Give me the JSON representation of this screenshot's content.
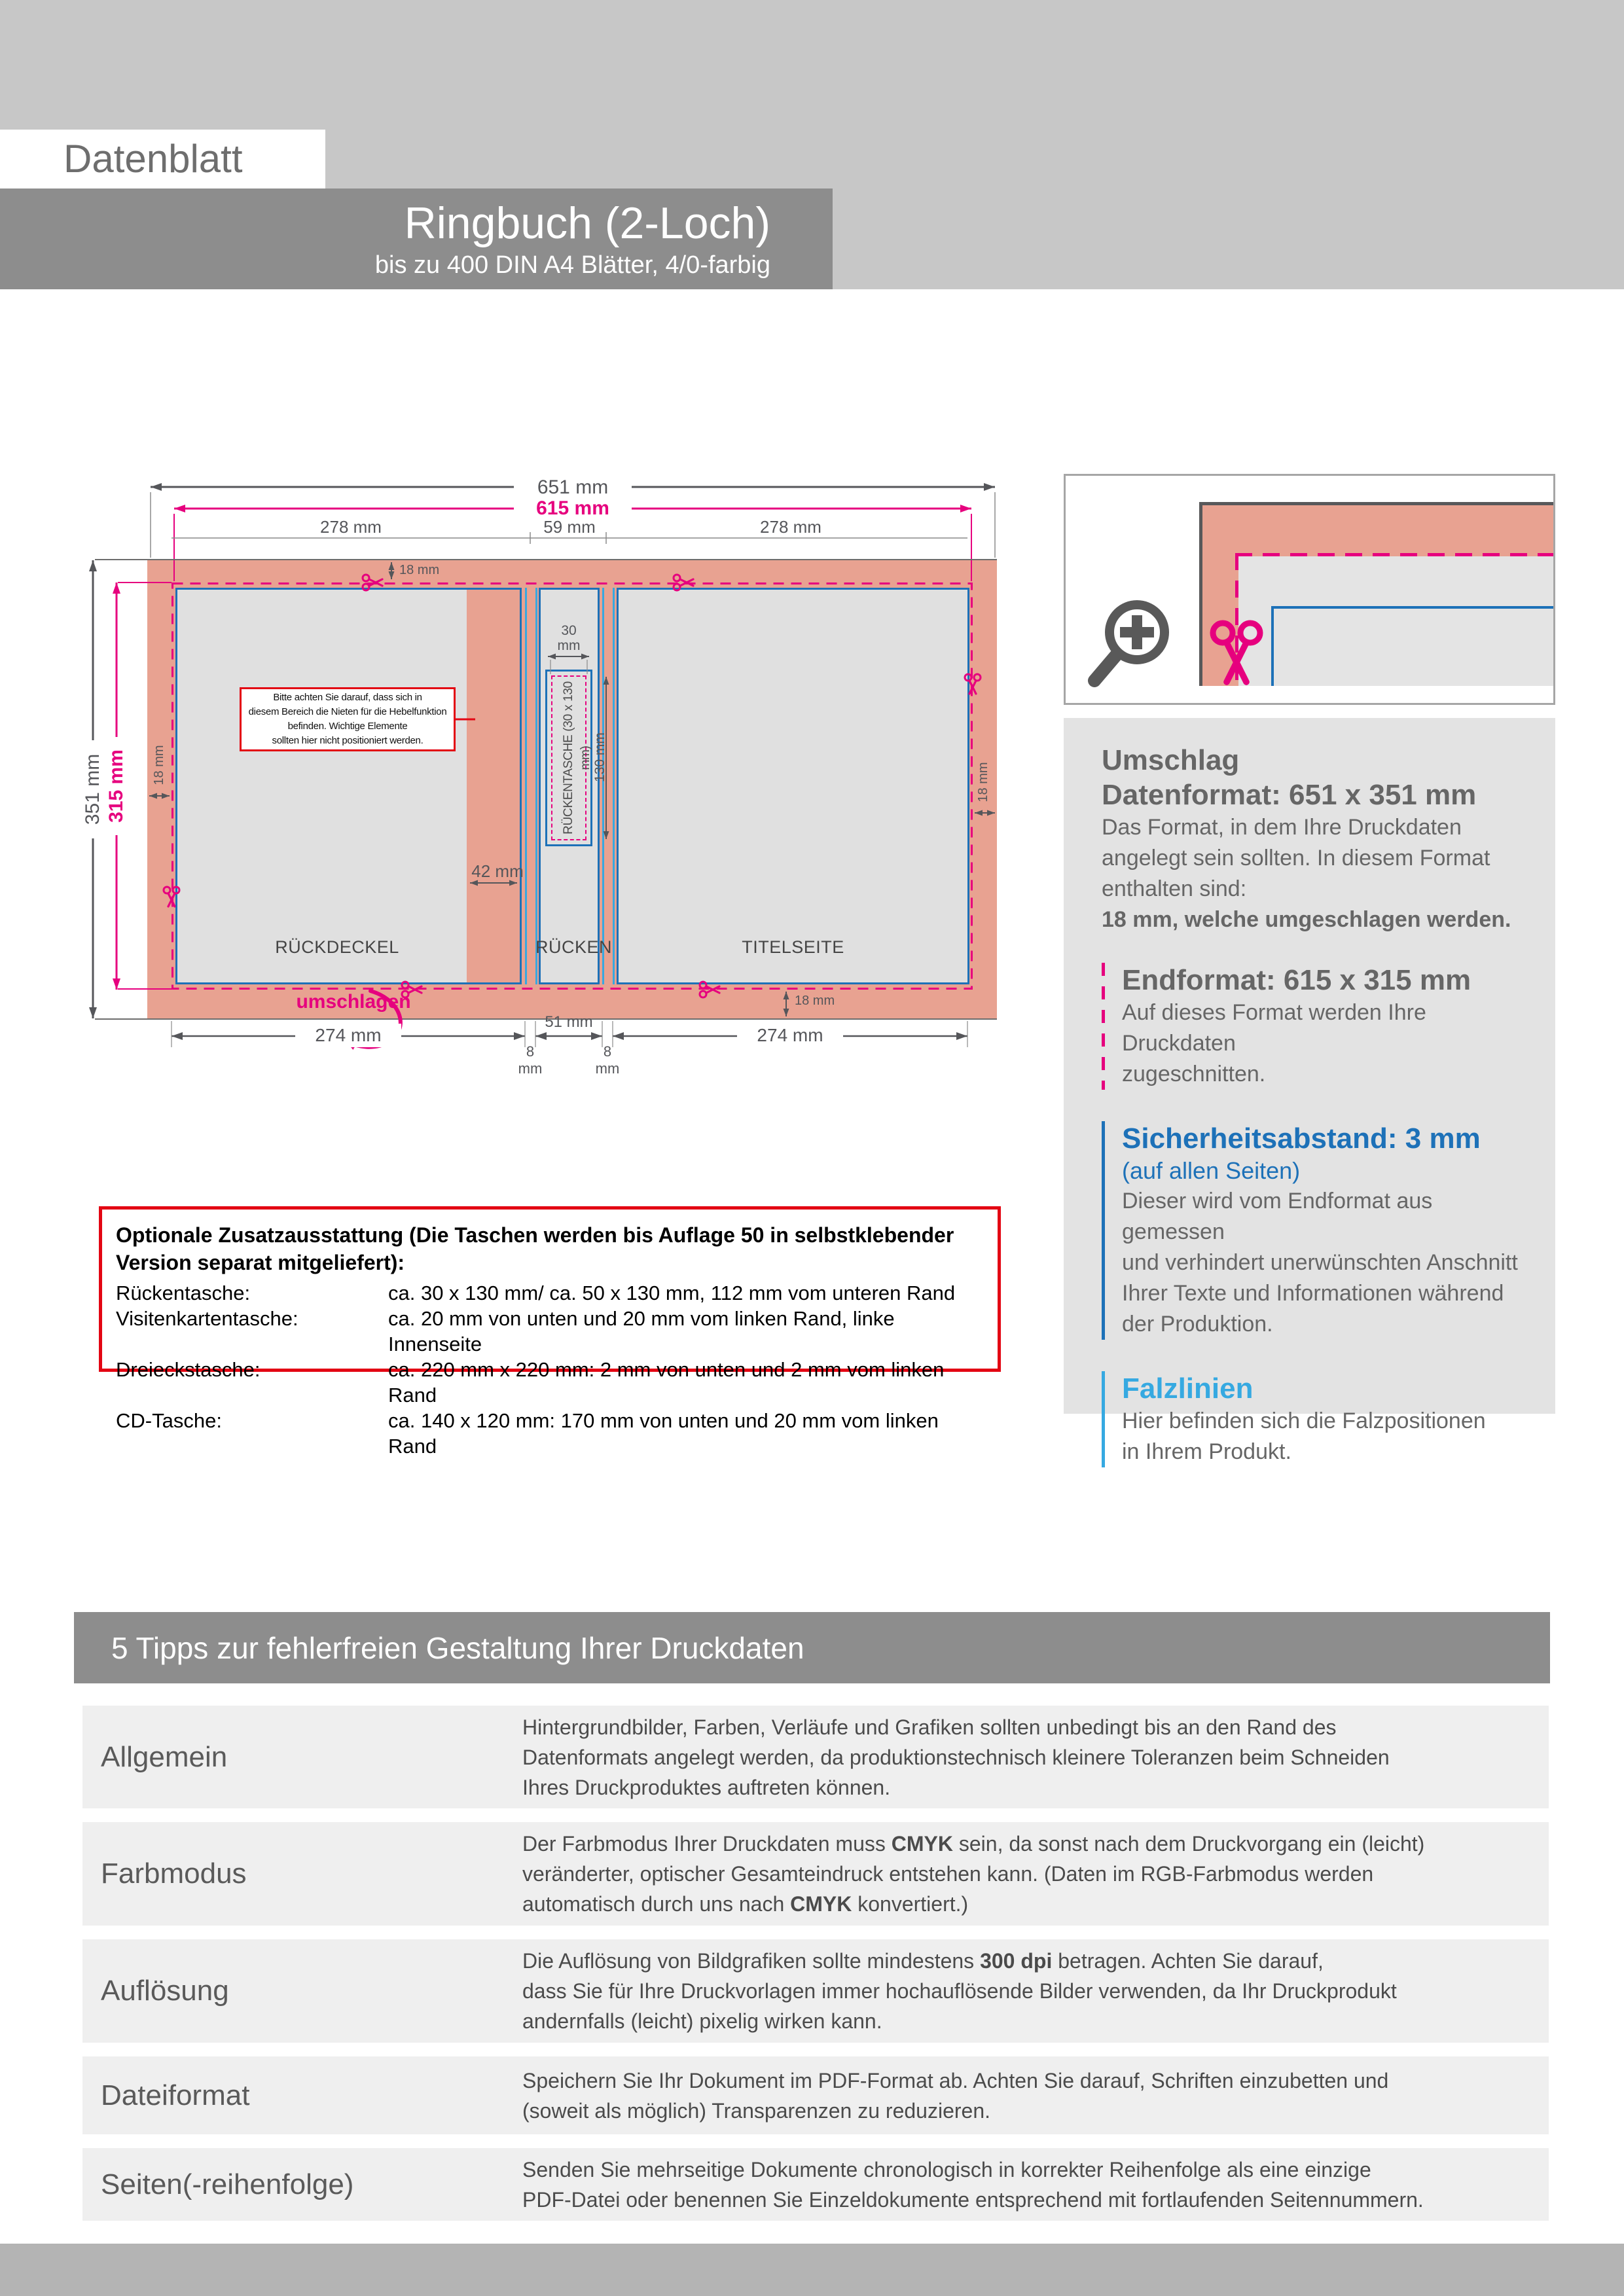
{
  "colors": {
    "header_light": "#c7c7c7",
    "band_gray": "#8d8d8d",
    "salmon": "#e8a291",
    "panel_fill": "#e0e0e0",
    "blue": "#1d71b8",
    "cyan": "#36a9e1",
    "pink": "#e6007e",
    "red": "#e30613",
    "dim_gray": "#55565a",
    "footer_gray": "#b4b4b4"
  },
  "header": {
    "tag": "Datenblatt",
    "title": "Ringbuch (2-Loch)",
    "subtitle": "bis zu 400 DIN A4 Blätter, 4/0-farbig"
  },
  "diagram": {
    "dims": {
      "total_w": "651 mm",
      "end_w": "615 mm",
      "seg_left": "278 mm",
      "seg_mid": "59 mm",
      "seg_right": "278 mm",
      "total_h": "351 mm",
      "end_h": "315 mm",
      "flap_top": "18 mm",
      "flap_left": "18 mm",
      "flap_right": "18 mm",
      "flap_bottom": "18 mm",
      "rivet_zone": "42 mm",
      "pocket_w": "30\nmm",
      "pocket_h": "130 mm",
      "bottom_left": "274 mm",
      "bottom_fold_left": "8\nmm",
      "bottom_spine": "51 mm",
      "bottom_fold_right": "8\nmm",
      "bottom_right": "274 mm",
      "fold_hint": "umschlagen"
    },
    "labels": {
      "back": "RÜCKDECKEL",
      "spine": "RÜCKEN",
      "front": "TITELSEITE",
      "pocket": "RÜCKENTASCHE (30 x 130 mm)"
    },
    "note": "Bitte achten Sie darauf, dass sich in\ndiesem Bereich die Nieten für die Hebelfunktion\nbefinden. Wichtige Elemente\nsollten hier nicht positioniert werden."
  },
  "info": {
    "umschlag_title": "Umschlag",
    "datenformat_title": "Datenformat: 651 x 351 mm",
    "datenformat_body": "Das Format, in dem Ihre Druckdaten\nangelegt sein sollten. In diesem Format\nenthalten sind:",
    "datenformat_bold": "18 mm, welche umgeschlagen werden.",
    "endformat_title": "Endformat: 615 x 315 mm",
    "endformat_body": "Auf dieses Format werden Ihre Druckdaten\nzugeschnitten.",
    "sicherheit_title": "Sicherheitsabstand: 3 mm",
    "sicherheit_sub": "(auf allen Seiten)",
    "sicherheit_body": "Dieser wird vom Endformat aus gemessen\nund verhindert unerwünschten Anschnitt\nIhrer Texte und Informationen während\nder Produktion.",
    "falz_title": "Falzlinien",
    "falz_body": "Hier befinden sich die Falzpositionen\nin Ihrem Produkt."
  },
  "optional": {
    "title": "Optionale Zusatzausstattung (Die Taschen werden bis Auflage 50 in selbstklebender\nVersion separat mitgeliefert):",
    "rows": [
      {
        "label": "Rückentasche:",
        "desc": "ca. 30 x 130 mm/ ca. 50 x 130 mm, 112 mm vom unteren Rand"
      },
      {
        "label": "Visitenkartentasche:",
        "desc": "ca. 20 mm von unten und 20 mm vom linken Rand, linke Innenseite"
      },
      {
        "label": "Dreieckstasche:",
        "desc": "ca. 220 mm x 220 mm: 2 mm von unten und 2 mm vom linken Rand"
      },
      {
        "label": "CD-Tasche:",
        "desc": "ca. 140 x 120 mm: 170 mm von unten und 20 mm vom linken Rand"
      }
    ]
  },
  "tips": {
    "title": "5 Tipps zur fehlerfreien Gestaltung Ihrer Druckdaten",
    "allgemein": {
      "label": "Allgemein",
      "text": "Hintergrundbilder, Farben, Verläufe und Grafiken sollten unbedingt bis an den Rand des\nDatenformats angelegt werden, da produktionstechnisch kleinere Toleranzen beim Schneiden\nIhres Druckproduktes auftreten können."
    },
    "farbmodus": {
      "label": "Farbmodus",
      "l1a": "Der Farbmodus Ihrer Druckdaten muss ",
      "l1b": "CMYK",
      "l1c": " sein, da sonst nach dem Druckvorgang ein (leicht)",
      "l2": "veränderter, optischer Gesamteindruck entstehen kann. (Daten im RGB-Farbmodus werden",
      "l3a": "automatisch durch uns nach ",
      "l3b": "CMYK",
      "l3c": " konvertiert.)"
    },
    "aufloesung": {
      "label": "Auflösung",
      "l1a": "Die Auflösung von Bildgrafiken sollte mindestens ",
      "l1b": "300 dpi",
      "l1c": " betragen. Achten Sie darauf,",
      "l2": "dass Sie für Ihre Druckvorlagen immer hochauflösende Bilder verwenden, da Ihr Druckprodukt",
      "l3": "andernfalls (leicht) pixelig wirken kann."
    },
    "dateiformat": {
      "label": "Dateiformat",
      "text": "Speichern Sie Ihr Dokument im PDF-Format ab. Achten Sie darauf, Schriften einzubetten und\n(soweit als möglich) Transparenzen zu reduzieren."
    },
    "seiten": {
      "label": "Seiten(-reihenfolge)",
      "text": "Senden Sie mehrseitige Dokumente chronologisch in korrekter Reihenfolge als eine einzige\nPDF-Datei oder benennen Sie Einzeldokumente entsprechend mit fortlaufenden Seitennummern."
    }
  }
}
